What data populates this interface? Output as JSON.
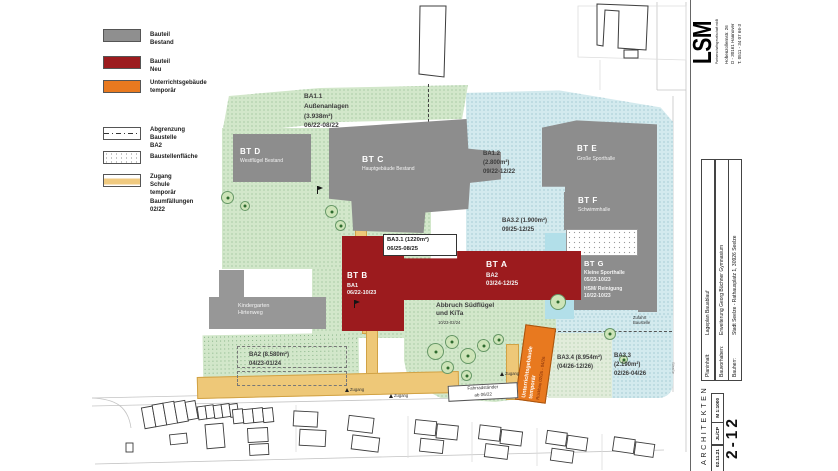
{
  "legend": {
    "items": [
      {
        "label": "Bauteil Bestand"
      },
      {
        "label": "Bauteil Neu"
      },
      {
        "label": "Unterrichtsgebäude\ntemporär"
      },
      {
        "label": "Abgrenzung\nBaustelle BA2"
      },
      {
        "label": "Baustellenfläche"
      },
      {
        "label": "Zugang Schule\ntemporär"
      },
      {
        "label": "Baumfällungen\n02/22"
      }
    ]
  },
  "plan": {
    "areas": {
      "ba11": "BA1.1\nAußenanlagen\n(3.938m²)\n06/22-08/22",
      "ba12": "BA1.2\n(2.800m²)\n09/22-12/22",
      "ba2": "BA2 (8.580m²)\n04/23-01/24",
      "ba31": "BA3.1 (1220m²)\n06/25-08/25",
      "ba32": "BA3.2 (1.900m²)\n09/25-12/25",
      "ba33": "BA3.3\n(2.190m²)\n02/26-04/26",
      "ba34": "BA3.4 (8.954m²)\n(04/26-12/26)",
      "abbruch_title": "Abbruch Südflügel\nund KiTa",
      "abbruch_period": "10/23-02/24"
    },
    "buildings": {
      "btA_title": "BT A",
      "btA_sub": "BA2\n03/24-12/25",
      "btB_title": "BT B",
      "btB_sub": "BA1\n06/22-10/23",
      "btC_title": "BT C",
      "btC_sub": "Hauptgebäude Bestand",
      "btD_title": "BT D",
      "btD_sub": "Westflügel Bestand",
      "btE_title": "BT E",
      "btE_sub": "Große Sporthalle",
      "btF_title": "BT F",
      "btF_sub": "Schwimmhalle",
      "btG_title": "BT G",
      "btG_sub": "Kleine Sporthalle\n05/23-10/23",
      "btG_sub2": "HSM/ Reinigung\n10/22-10/23",
      "kindergarten": "Kindergarten\nHirtenweg"
    },
    "temp_building": {
      "line1": "Unterrichtsgebäude",
      "line2": "temporär",
      "line3": "Rückbau 02/26 - 04/26"
    },
    "labels": {
      "fahrrad": "Fahrradständer\nab 06/22",
      "zufahrt": "Zufahrt\nBaustelle",
      "zugang": "Zugang",
      "street": "Straße"
    }
  },
  "titleblock": {
    "logo": "LSM",
    "logo_sub": "Partnerschaftsgesellschaft mbB",
    "address": "Hohenzollernstr. 26\nD - 30161 Hannover\nT. 0511 - 34 07 66-3",
    "rows": [
      {
        "key": "Planinhalt:",
        "value": "Lageplan Bauablauf"
      },
      {
        "key": "Bauvorhaben:",
        "value": "Erweiterung Georg Büchner Gymnasium"
      },
      {
        "key": "Bauherr:",
        "value": "Stadt Seelze - Rathausplatz 1, 30926 Seelze"
      }
    ],
    "scale": "M 1:1000",
    "initials": "JL/CP",
    "date": "02.11.21",
    "sheet": "2-12",
    "firm": "ARCHITEKTEN"
  }
}
